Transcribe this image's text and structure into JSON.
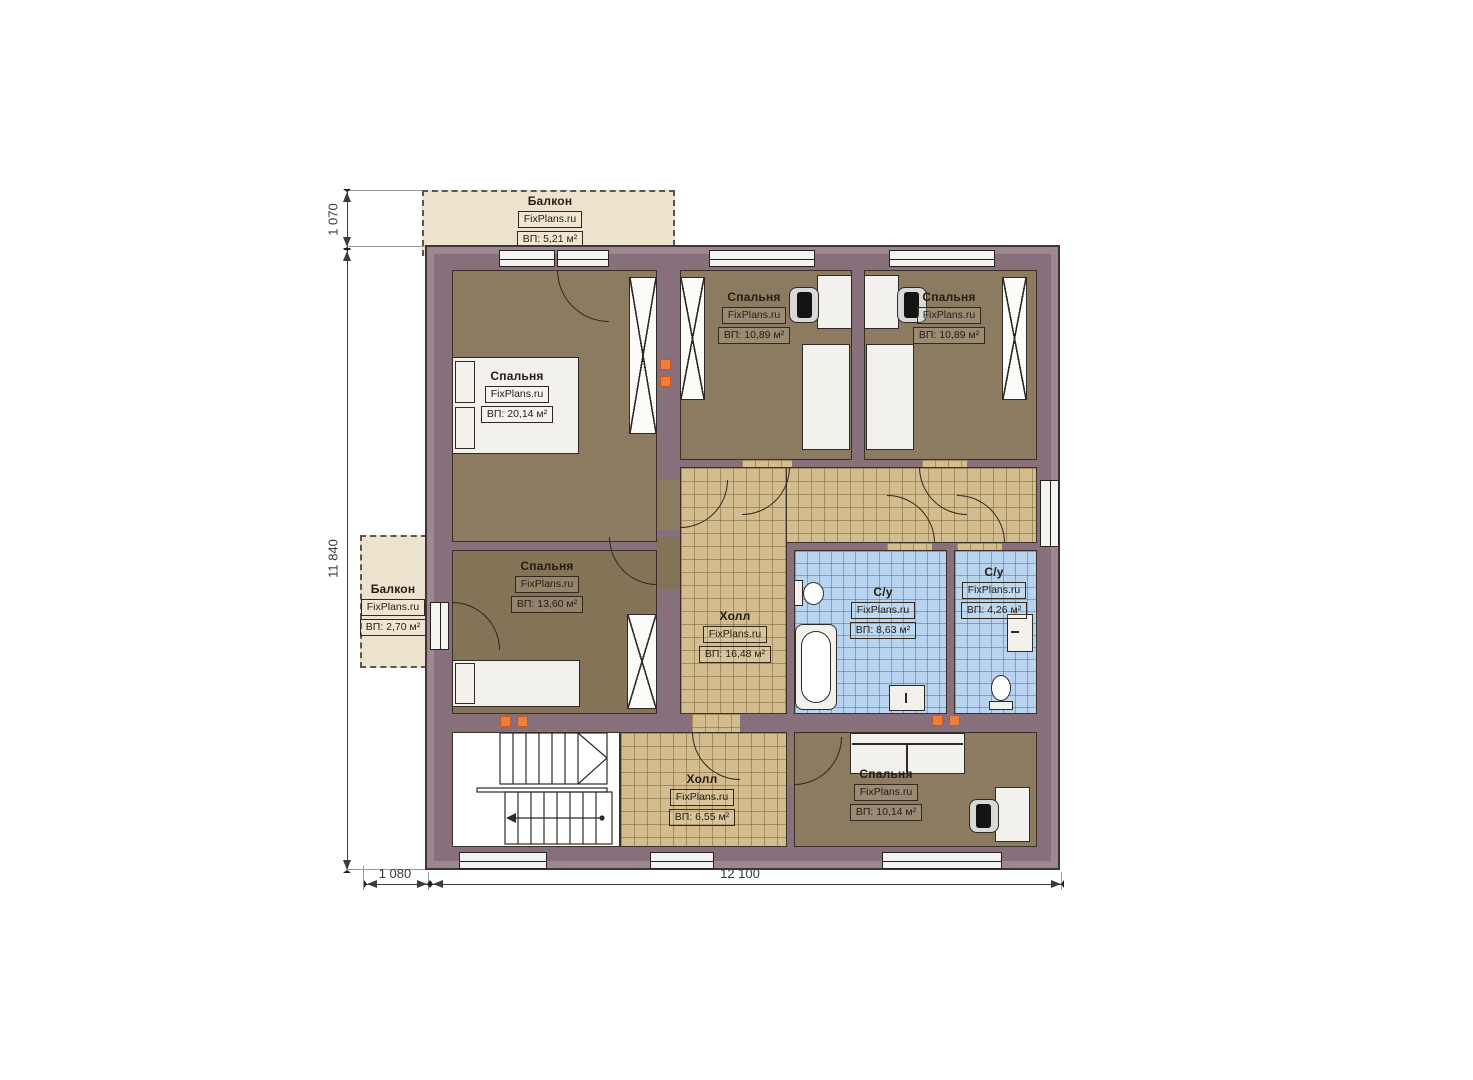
{
  "plan": {
    "brand": "FixPlans.ru",
    "rooms": [
      {
        "id": "balcony-top",
        "name": "Балкон",
        "area": "ВП: 5,21 м²"
      },
      {
        "id": "bedroom-top-left",
        "name": "Спальня",
        "area": "ВП: 20,14 м²"
      },
      {
        "id": "bedroom-top-middle",
        "name": "Спальня",
        "area": "ВП: 10,89 м²"
      },
      {
        "id": "bedroom-top-right",
        "name": "Спальня",
        "area": "ВП: 10,89 м²"
      },
      {
        "id": "balcony-left",
        "name": "Балкон",
        "area": "ВП: 2,70 м²"
      },
      {
        "id": "bedroom-mid-left",
        "name": "Спальня",
        "area": "ВП: 13,60 м²"
      },
      {
        "id": "hall-main",
        "name": "Холл",
        "area": "ВП: 16,48 м²"
      },
      {
        "id": "bathroom-large",
        "name": "С/у",
        "area": "ВП: 8,63 м²"
      },
      {
        "id": "bathroom-small",
        "name": "С/у",
        "area": "ВП: 4,26 м²"
      },
      {
        "id": "hall-bottom",
        "name": "Холл",
        "area": "ВП: 6,55 м²"
      },
      {
        "id": "bedroom-bottom",
        "name": "Спальня",
        "area": "ВП: 10,14 м²"
      }
    ],
    "dimensions": {
      "balcony_height": "1 070",
      "building_height": "11 840",
      "balcony_width": "1 080",
      "building_width": "12 100"
    },
    "colors": {
      "wall": "#87707b",
      "floor_wood": "#8c7b61",
      "tile_beige": "#d3bd8f",
      "tile_blue": "#b7d3ef",
      "balcony": "#ece3cc",
      "vent": "#ee7d3e"
    }
  }
}
